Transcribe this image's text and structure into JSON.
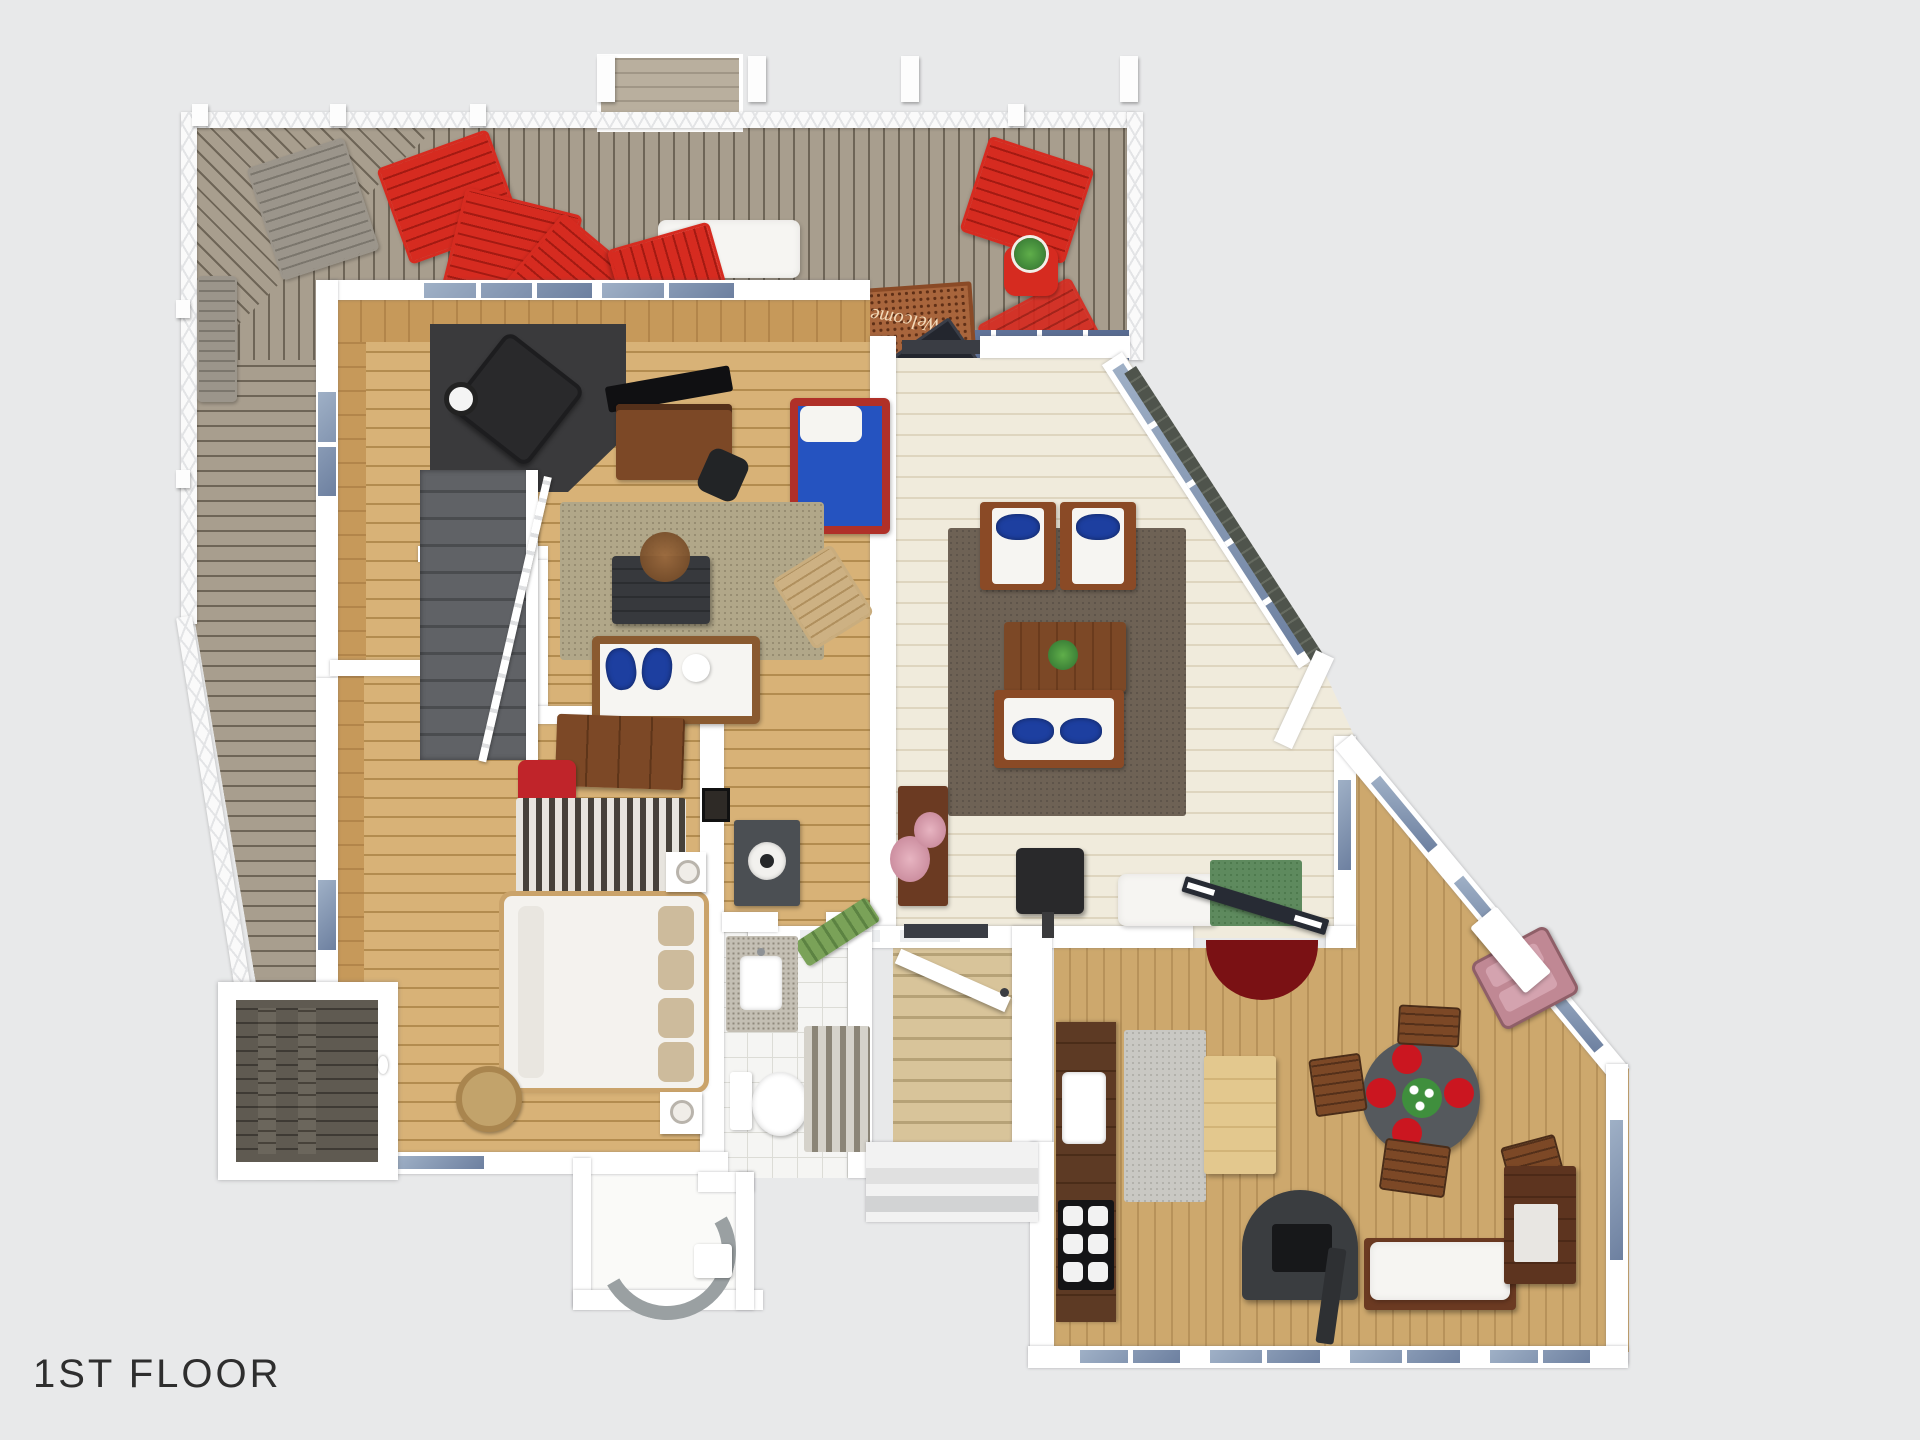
{
  "label": {
    "text": "1ST FLOOR"
  },
  "deck": {
    "mat_text": "Welcome"
  },
  "colors": {
    "bg": "#e8e9ea",
    "wall": "#ffffff",
    "railing": "#fafafa",
    "railing_line": "#e3e4e6",
    "deck_light": "#a89e8e",
    "deck_gap": "#6e6557",
    "red": "#d62b20",
    "red_dark": "#a31a12",
    "wood_light": "#d8b277",
    "wood_seam": "#b38c4f",
    "cream": "#f0ebdc",
    "cream_line": "#ded5bf",
    "ramp": "#d8c49a",
    "ramp_line": "#b6a277",
    "tile": "#f5f5f3",
    "grout": "#dcdcd6",
    "rug_beige": "#b1a789",
    "rug_beige_dot": "#978d72",
    "rug_taupe": "#6e6255",
    "rug_taupe_dot": "#5e544a",
    "rug_gray": "#c9c8c3",
    "rug_green": "#5e8a5e",
    "rug_red": "#7a1114",
    "stripe_dark": "#46413a",
    "stripe_light": "#e7e4de",
    "navy": "#1d3fa0",
    "blue_mattress": "#2553c0",
    "chest": "#37393d",
    "black": "#29292b",
    "walnut": "#5d3a24",
    "wood_furn": "#7c4826",
    "island": "#e3c88e",
    "tan_chair": "#cdb183",
    "table_gray": "#55595d",
    "plate_red": "#cb1620",
    "duvet": "#f4f2ee",
    "pillow_tan": "#cdbb9c",
    "sauna_mid": "#5f5a51",
    "glass": "#9fb0c6",
    "glass_dark": "#6d80a0",
    "mat": "#a8653c",
    "mat_dark": "#5f2f16",
    "pink": "#c08894",
    "plant": "#3f8f3d",
    "white_furn": "#f6f5f2",
    "gray_furn": "#9b958b",
    "text": "#2e2e2e"
  }
}
